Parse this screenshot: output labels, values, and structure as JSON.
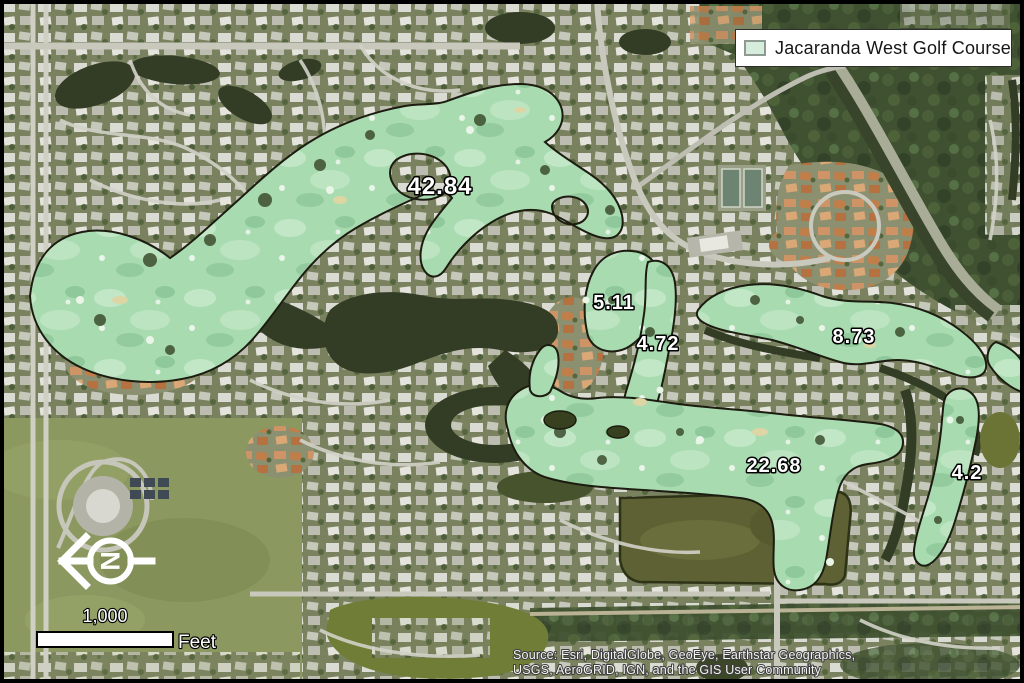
{
  "map": {
    "legend": {
      "label": "Jacaranda West Golf Course",
      "swatch_color": "#d6ecdd"
    },
    "area_labels": [
      {
        "value": "42.84"
      },
      {
        "value": "5.11"
      },
      {
        "value": "4.72"
      },
      {
        "value": "8.73"
      },
      {
        "value": "22.68"
      },
      {
        "value": "4.2"
      }
    ],
    "north_arrow": {
      "letter": "N"
    },
    "scale_bar": {
      "distance": "1,000",
      "unit": "Feet"
    },
    "attribution": {
      "line1": "Source: Esri, DigitalGlobe, GeoEye, Earthstar Geographics,",
      "line2": "USGS, AeroGRID, IGN, and the GIS User Community"
    },
    "colors": {
      "golf_overlay_fill": "#a8dab0",
      "golf_overlay_outline": "#1c1c10",
      "water": "#333d25",
      "map_border": "#000000"
    }
  }
}
